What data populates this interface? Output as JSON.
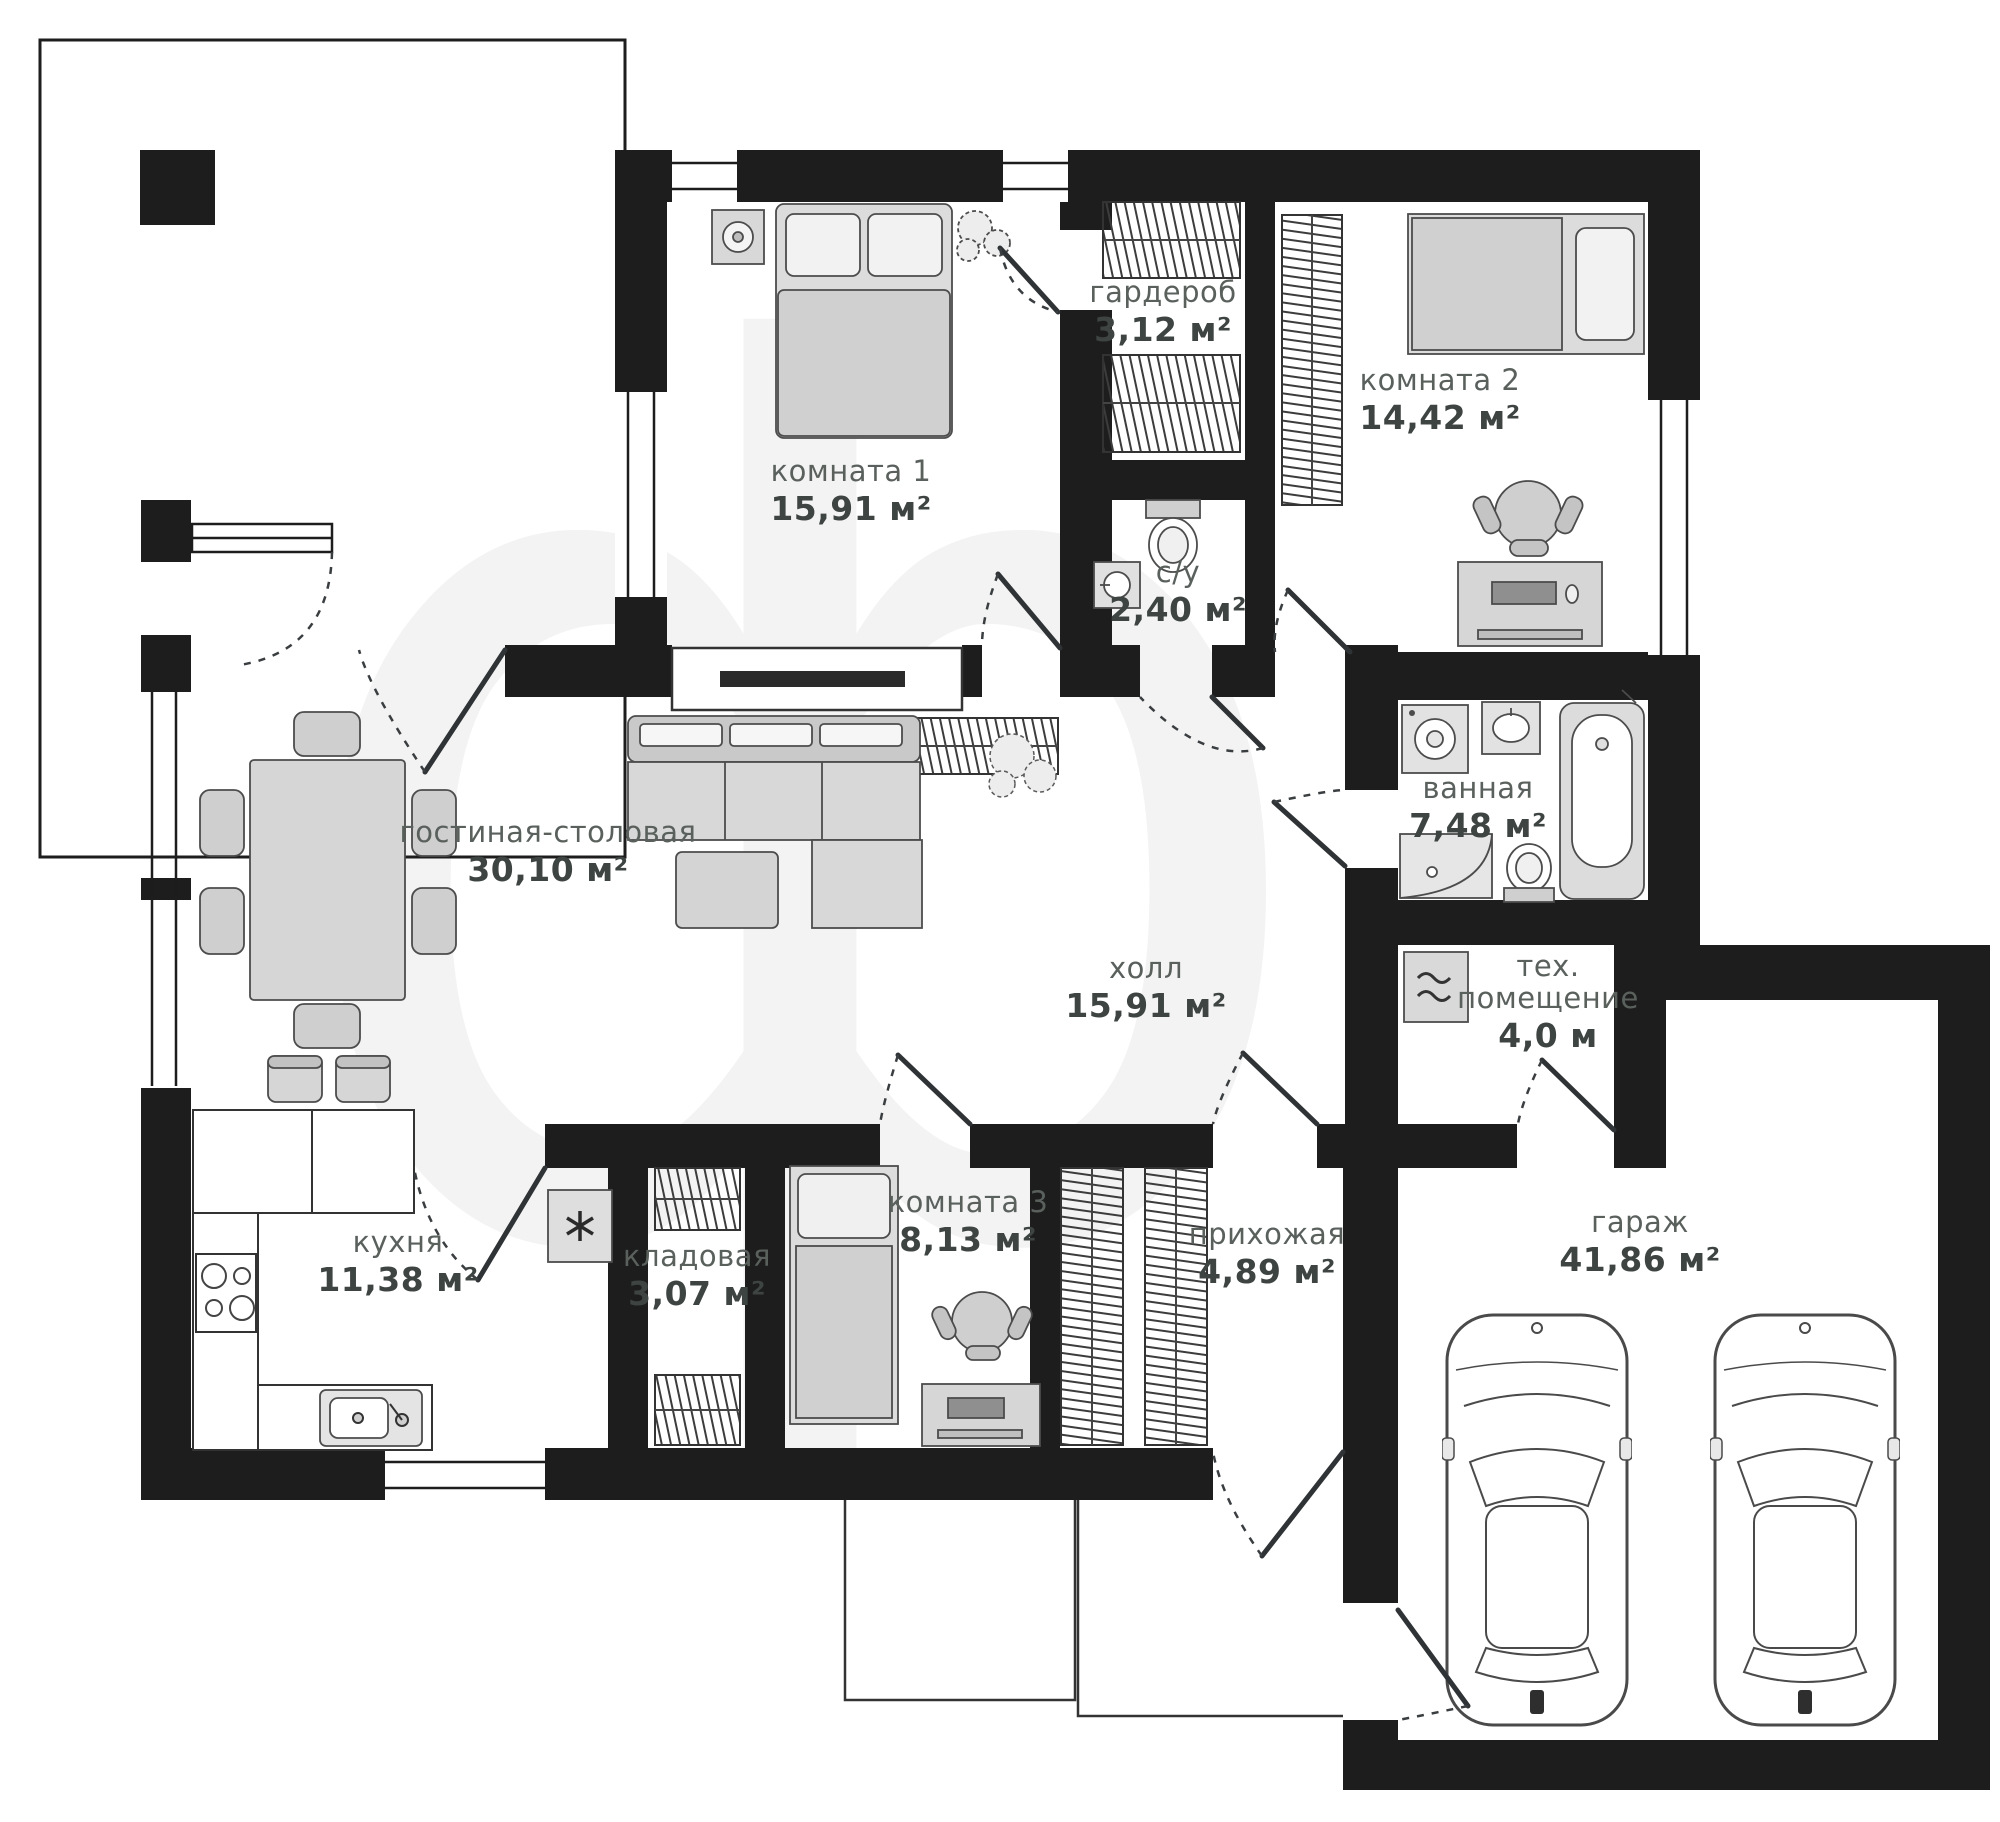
{
  "plan": {
    "watermark": "ф",
    "rooms": [
      {
        "id": "room1",
        "name": "комната 1",
        "area": "15,91 м²"
      },
      {
        "id": "wardrobe",
        "name": "гардероб",
        "area": "3,12 м²"
      },
      {
        "id": "room2",
        "name": "комната 2",
        "area": "14,42 м²"
      },
      {
        "id": "wc",
        "name": "с/у",
        "area": "2,40 м²"
      },
      {
        "id": "bathroom",
        "name": "ванная",
        "area": "7,48 м²"
      },
      {
        "id": "living",
        "name": "гостиная-столовая",
        "area": "30,10 м²"
      },
      {
        "id": "hall",
        "name": "холл",
        "area": "15,91 м²"
      },
      {
        "id": "tech",
        "name": "тех.",
        "name2": "помещение",
        "area": "4,0 м"
      },
      {
        "id": "kitchen",
        "name": "кухня",
        "area": "11,38 м²"
      },
      {
        "id": "pantry",
        "name": "кладовая",
        "area": "3,07 м²"
      },
      {
        "id": "room3",
        "name": "комната 3",
        "area": "8,13 м²"
      },
      {
        "id": "entry",
        "name": "прихожая",
        "area": "4,89 м²"
      },
      {
        "id": "garage",
        "name": "гараж",
        "area": "41,86 м²"
      }
    ],
    "colors": {
      "wall": "#1d1d1d",
      "furniture": "#d8d8d8",
      "furniture_stroke": "#4a4a4a",
      "label": "#5a615d",
      "area_text": "#3d4441",
      "watermark": "#f3f3f3"
    }
  }
}
